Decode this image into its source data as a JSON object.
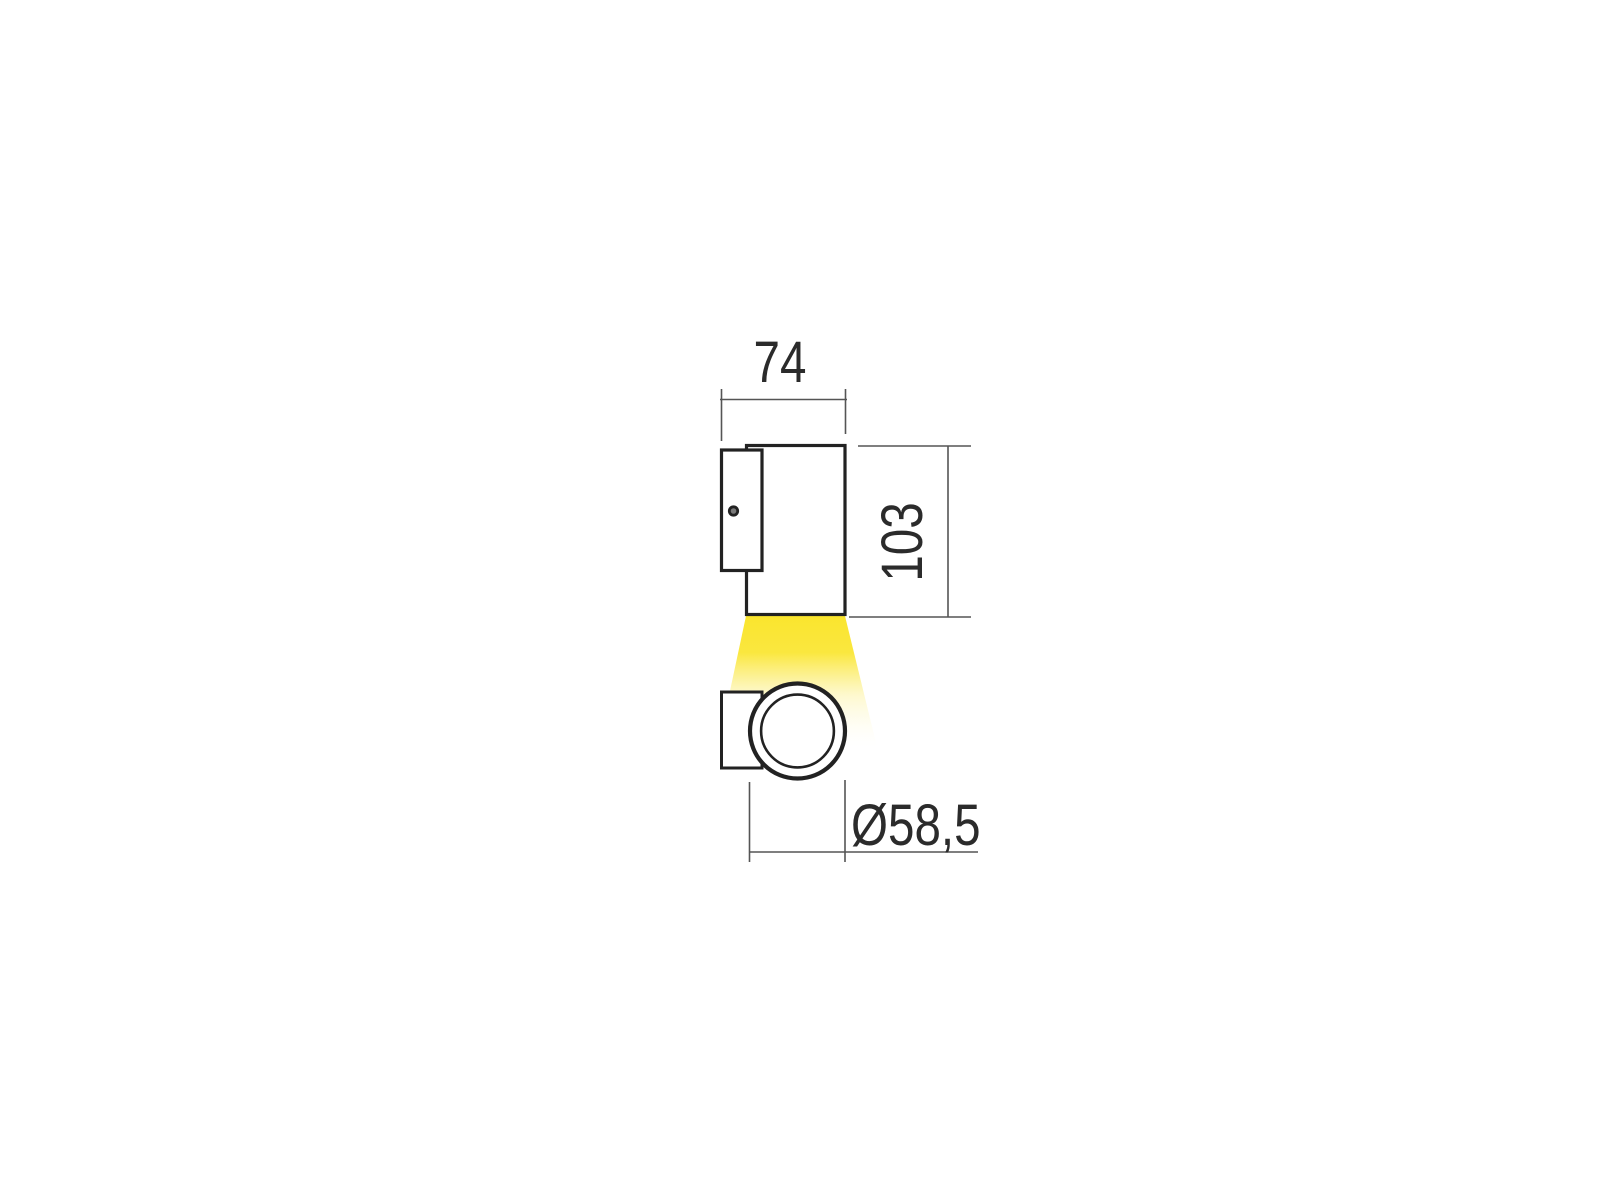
{
  "drawing": {
    "labels": {
      "width": "74",
      "height": "103",
      "diameter": "Ø58,5"
    },
    "colors": {
      "background": "#ffffff",
      "object_line": "#222222",
      "dim_line": "#555555",
      "text": "#2b2b2b",
      "screw_fill": "#7a7a7a",
      "beam_top": "#fae52e",
      "beam_mid": "#fdf6bc",
      "beam_end": "#fffdf0"
    }
  }
}
